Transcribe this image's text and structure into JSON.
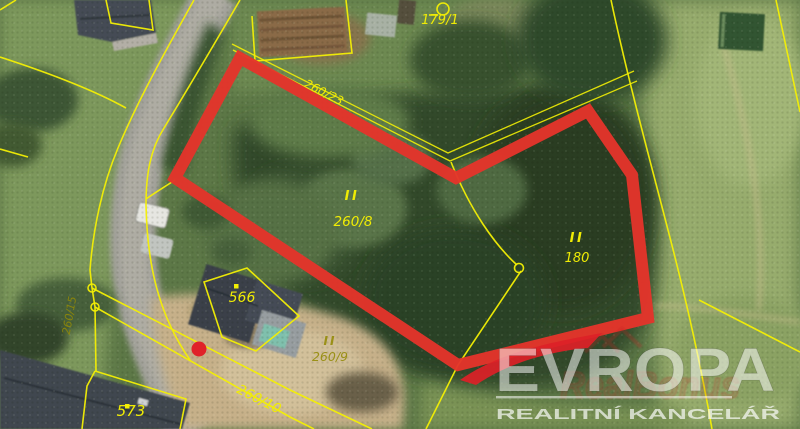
{
  "cadastre": {
    "class_mark": "II",
    "labels": {
      "p179_1": "179/1",
      "p260_23": "260/23",
      "p260_8": "260/8",
      "p180": "180",
      "b566": "566",
      "p260_9": "260/9",
      "p260_10": "260/10",
      "b573": "573",
      "p260_15": "260/15"
    },
    "line_color": "#f3ef04"
  },
  "highlight": {
    "outline_color": "#e4342b",
    "marker_color": "#e02229"
  },
  "watermark": {
    "brand": "EVROPA",
    "subtitle": "REALITNÍ KANCELÁŘ",
    "accent_color": "#dd2127",
    "faint_mark": "RealBonus"
  }
}
